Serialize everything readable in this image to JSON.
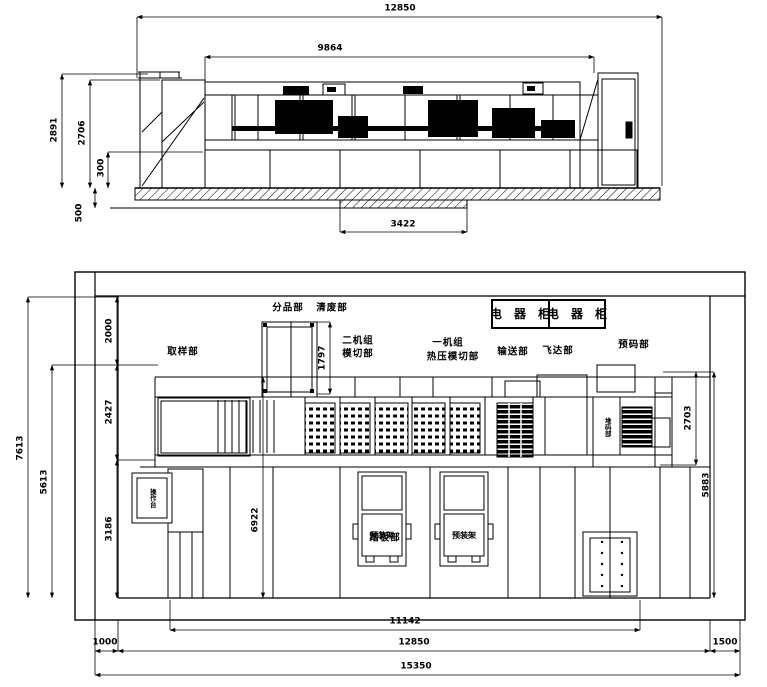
{
  "elevation": {
    "dims": {
      "overall_length": "12850",
      "machine_length": "9864",
      "pit_length": "3422",
      "overall_height": "2891",
      "machine_height": "2706",
      "base_height": "300",
      "pit_depth": "500"
    }
  },
  "plan": {
    "dims": {
      "top_margin": "2000",
      "machine_width": "2427",
      "front_area": "3186",
      "work_width": "5613",
      "overall_width": "7613",
      "tower_width": "1797",
      "floor_width": "6922",
      "stacker_width": "2703",
      "right_width": "5883",
      "inner_length": "11142",
      "machine_length": "12850",
      "left_margin": "1000",
      "right_margin": "1500",
      "overall_length": "15350"
    },
    "labels": {
      "electrical_cabinet": "电 器 柜",
      "sampling": "取样部",
      "sorting": "分品部",
      "waste_removal": "清废部",
      "unit2_line1": "二机组",
      "unit2_line2": "模切部",
      "unit1_line1": "一机组",
      "unit1_line2": "热压模切部",
      "conveying": "输送部",
      "feeder": "飞达部",
      "prestacking": "预码部",
      "stacking": "堆码部",
      "footboard": "踏板部",
      "preload_rack": "预装架",
      "console": "操作台"
    }
  },
  "colors": {
    "line": "#000000",
    "background": "#ffffff"
  }
}
